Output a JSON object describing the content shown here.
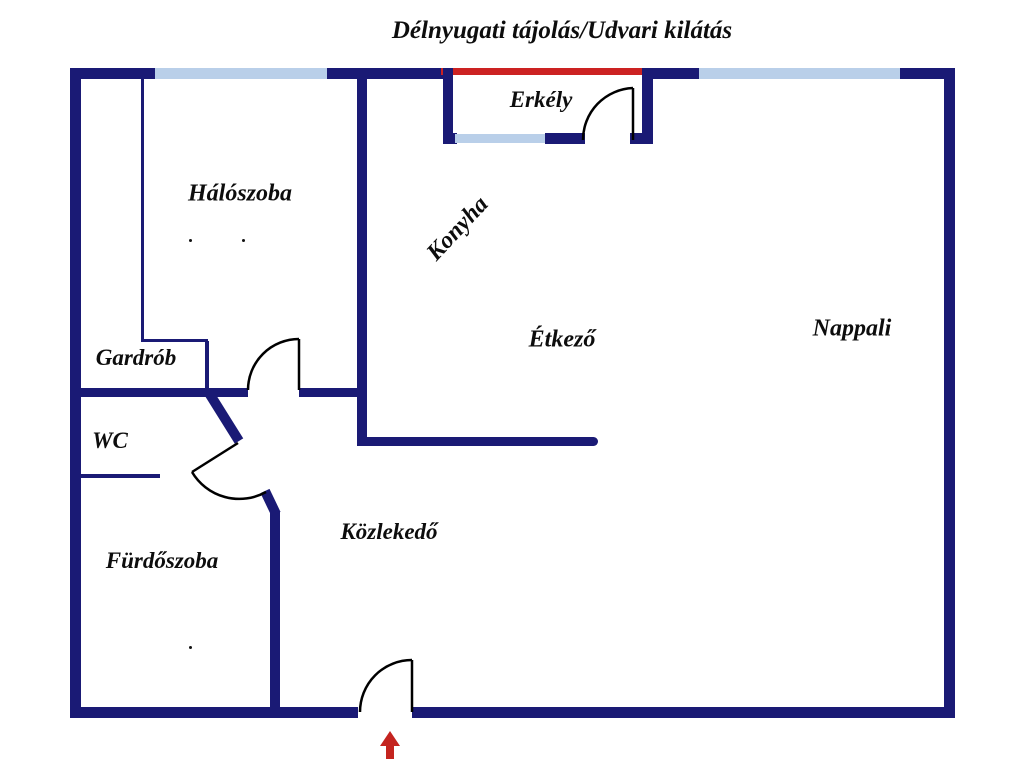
{
  "title": "Délnyugati tájolás/Udvari kilátás",
  "rooms": {
    "bedroom": {
      "label": "Hálószoba"
    },
    "wardrobe": {
      "label": "Gardrób"
    },
    "wc": {
      "label": "WC"
    },
    "bathroom": {
      "label": "Fürdőszoba"
    },
    "hallway": {
      "label": "Közlekedő"
    },
    "kitchen": {
      "label": "Konyha"
    },
    "dining": {
      "label": "Étkező"
    },
    "living": {
      "label": "Nappali"
    },
    "balcony": {
      "label": "Erkély"
    }
  },
  "colors": {
    "wall": "#1a1a75",
    "window": "#b9cfe9",
    "balcony_edge": "#cc2222",
    "door_line": "#000000",
    "entrance_arrow": "#c4241f",
    "text": "#0d0d0d",
    "background": "#ffffff"
  },
  "icons": {
    "entrance_arrow": "up-arrow"
  }
}
